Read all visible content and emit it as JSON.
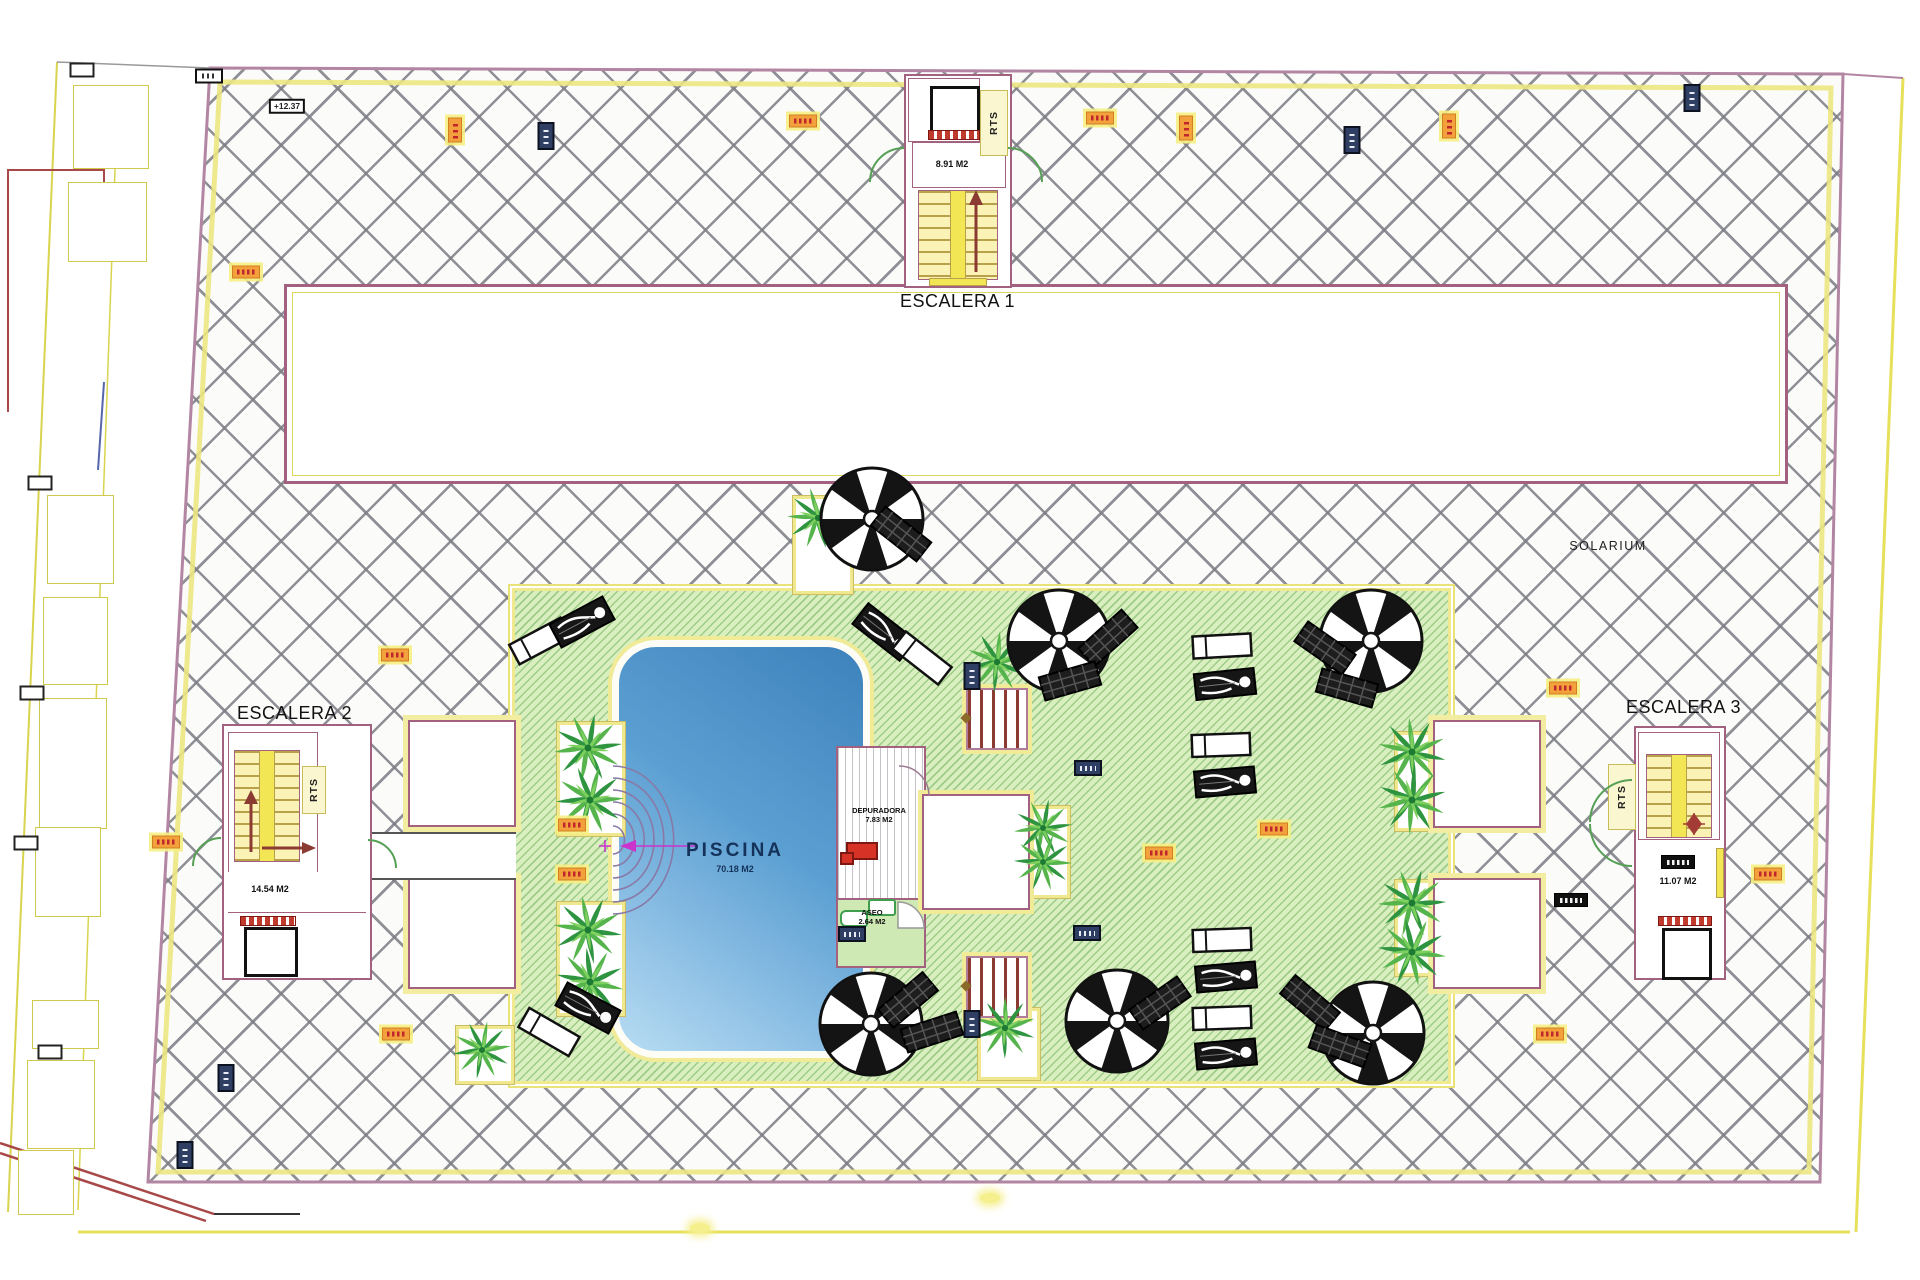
{
  "labels": {
    "escalera1": "ESCALERA 1",
    "escalera2": "ESCALERA 2",
    "escalera3": "ESCALERA 3",
    "rts": "RTS",
    "solarium": "SOLARIUM",
    "piscina": "PISCINA",
    "piscina_area": "70.18 M2",
    "depuradora": "DEPURADORA",
    "depuradora_area": "7.83 M2",
    "aseo": "ASEO",
    "aseo_area": "2.64 M2",
    "escalera1_area": "8.91 M2",
    "escalera2_area": "14.54 M2",
    "escalera3_area": "11.07 M2"
  },
  "colors": {
    "boundary_pink": "#b286a2",
    "band_yellow": "#ece781",
    "deck_green": "#d9efbf",
    "pool_blue_dark": "#3e82bd",
    "pool_blue_light": "#b7dcf2",
    "accent_red": "#c0272d",
    "stair_yellow": "#f3e655"
  },
  "decor": {
    "palms": [
      [
        588,
        748,
        1,
        0
      ],
      [
        590,
        800,
        1,
        40
      ],
      [
        588,
        930,
        1,
        15
      ],
      [
        590,
        982,
        1,
        55
      ],
      [
        818,
        518,
        0.9,
        10
      ],
      [
        997,
        662,
        0.9,
        30
      ],
      [
        1043,
        828,
        0.85,
        0
      ],
      [
        1043,
        862,
        0.85,
        45
      ],
      [
        1412,
        752,
        1,
        20
      ],
      [
        1412,
        800,
        1,
        65
      ],
      [
        1412,
        903,
        1,
        5
      ],
      [
        1412,
        952,
        1,
        50
      ],
      [
        1005,
        1028,
        0.9,
        25
      ],
      [
        482,
        1050,
        0.85,
        35
      ]
    ],
    "parasols": [
      [
        872,
        519
      ],
      [
        1059,
        641
      ],
      [
        1371,
        641
      ],
      [
        871,
        1024
      ],
      [
        1117,
        1021
      ],
      [
        1373,
        1033
      ]
    ],
    "loungers": [
      [
        540,
        641,
        -28,
        "white"
      ],
      [
        582,
        622,
        -28,
        "person"
      ],
      [
        884,
        632,
        38,
        "person"
      ],
      [
        922,
        658,
        38,
        "white"
      ],
      [
        901,
        534,
        38,
        "dark"
      ],
      [
        1108,
        638,
        -42,
        "dark"
      ],
      [
        1070,
        681,
        -16,
        "dark"
      ],
      [
        1222,
        646,
        -3,
        "white"
      ],
      [
        1225,
        684,
        -6,
        "person"
      ],
      [
        1221,
        745,
        -2,
        "white"
      ],
      [
        1225,
        782,
        -5,
        "person"
      ],
      [
        1325,
        648,
        35,
        "dark"
      ],
      [
        1347,
        688,
        16,
        "dark"
      ],
      [
        549,
        1032,
        30,
        "white"
      ],
      [
        588,
        1008,
        28,
        "person"
      ],
      [
        908,
        1000,
        -40,
        "dark"
      ],
      [
        932,
        1032,
        -18,
        "dark"
      ],
      [
        1160,
        1003,
        -35,
        "dark"
      ],
      [
        1222,
        940,
        -2,
        "white"
      ],
      [
        1226,
        977,
        -5,
        "person"
      ],
      [
        1222,
        1018,
        -2,
        "white"
      ],
      [
        1226,
        1054,
        -5,
        "person"
      ],
      [
        1310,
        1003,
        40,
        "dark"
      ],
      [
        1340,
        1046,
        20,
        "dark"
      ]
    ],
    "markers": [
      [
        "white-label",
        287,
        106,
        "+12.37"
      ],
      [
        "white-blank",
        209,
        76,
        ""
      ],
      [
        "orange-h",
        803,
        121,
        ""
      ],
      [
        "orange-h",
        1100,
        118,
        ""
      ],
      [
        "orange-v",
        455,
        130,
        ""
      ],
      [
        "orange-v",
        1186,
        128,
        ""
      ],
      [
        "orange-v",
        1449,
        126,
        ""
      ],
      [
        "navy-v",
        546,
        136,
        ""
      ],
      [
        "navy-v",
        1352,
        140,
        ""
      ],
      [
        "navy-v",
        1692,
        98,
        ""
      ],
      [
        "orange-h",
        246,
        272,
        ""
      ],
      [
        "orange-h",
        395,
        655,
        ""
      ],
      [
        "orange-h",
        1563,
        688,
        ""
      ],
      [
        "orange-h",
        166,
        842,
        ""
      ],
      [
        "orange-h",
        572,
        825,
        ""
      ],
      [
        "orange-h",
        572,
        874,
        ""
      ],
      [
        "orange-h",
        1159,
        853,
        ""
      ],
      [
        "orange-h",
        1274,
        829,
        ""
      ],
      [
        "navy-h",
        1088,
        768,
        ""
      ],
      [
        "navy-h",
        1087,
        933,
        ""
      ],
      [
        "navy-v",
        972,
        676,
        ""
      ],
      [
        "navy-v",
        972,
        1024,
        ""
      ],
      [
        "navy-h",
        852,
        934,
        ""
      ],
      [
        "black-label",
        1571,
        900,
        ""
      ],
      [
        "black-label",
        1678,
        862,
        ""
      ],
      [
        "orange-h",
        1768,
        874,
        ""
      ],
      [
        "orange-h",
        1550,
        1034,
        ""
      ],
      [
        "orange-h",
        396,
        1034,
        ""
      ],
      [
        "navy-v",
        226,
        1078,
        ""
      ],
      [
        "navy-v",
        185,
        1155,
        ""
      ],
      [
        "yellow-blob",
        700,
        1228,
        ""
      ],
      [
        "yellow-blob",
        990,
        1198,
        ""
      ]
    ],
    "terraces": [
      [
        73,
        85,
        74,
        82
      ],
      [
        68,
        182,
        77,
        78
      ],
      [
        47,
        495,
        65,
        87
      ],
      [
        43,
        597,
        63,
        86
      ],
      [
        39,
        698,
        66,
        129
      ],
      [
        35,
        827,
        64,
        88
      ],
      [
        32,
        1000,
        65,
        47
      ],
      [
        27,
        1060,
        66,
        87
      ],
      [
        18,
        1150,
        54,
        63
      ]
    ],
    "pillars": [
      [
        82,
        70
      ],
      [
        40,
        483
      ],
      [
        32,
        693
      ],
      [
        26,
        843
      ],
      [
        50,
        1052
      ]
    ]
  }
}
